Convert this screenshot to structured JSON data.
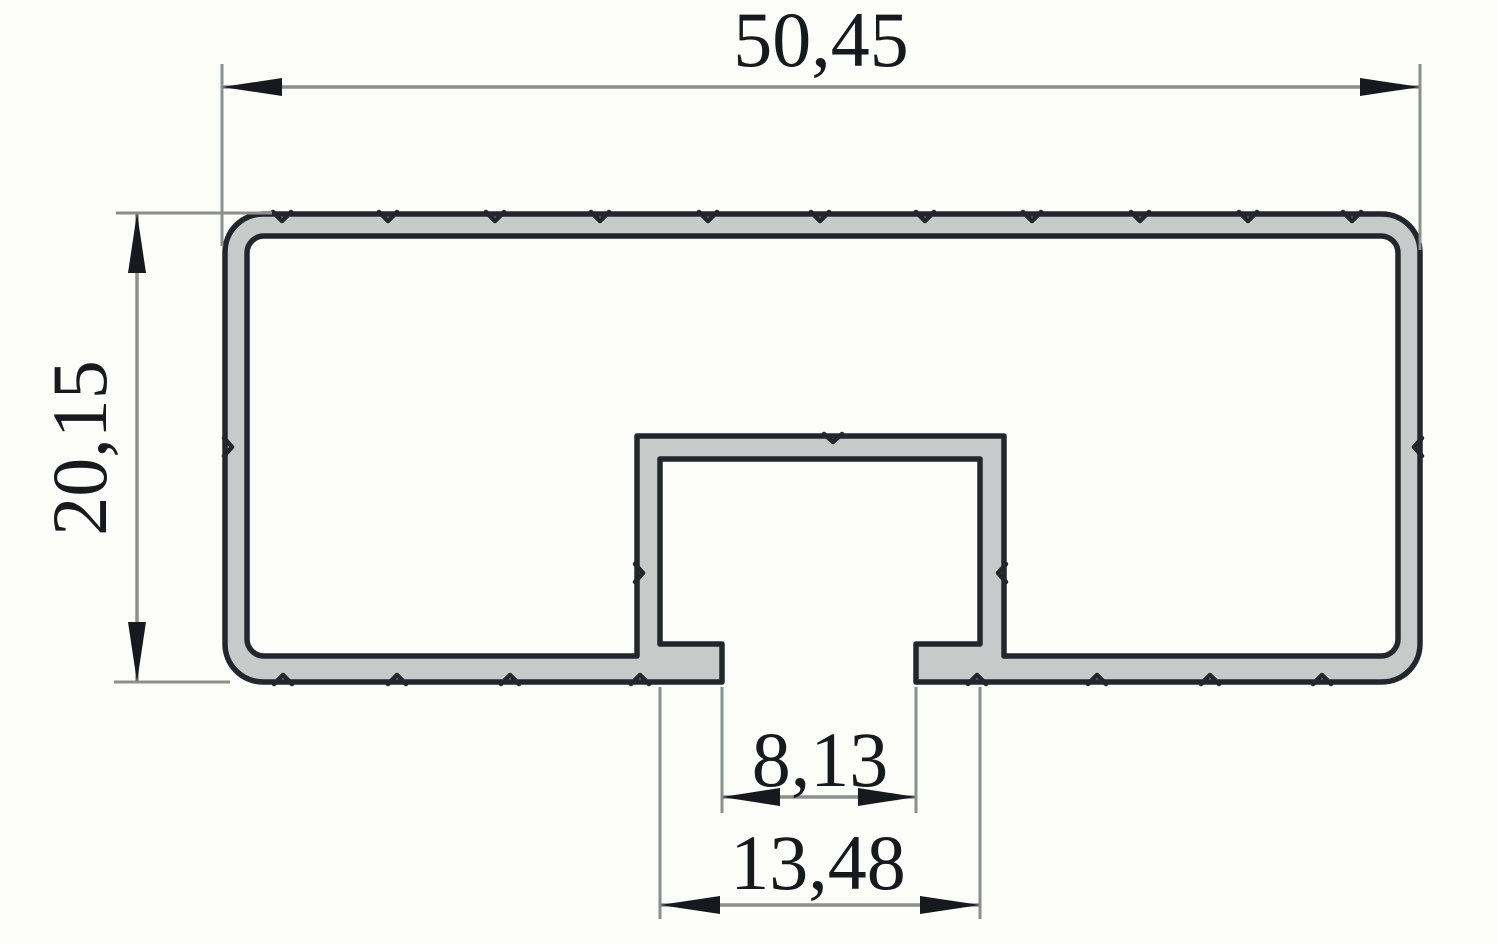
{
  "drawing": {
    "kind": "technical-cross-section",
    "subject": "rectangular-tube-profile-with-bottom-channel-slot",
    "colors": {
      "background": "#fcfcf9",
      "profile_fill": "#c6cac9",
      "outline": "#23262c",
      "dimension_line": "#8b8f8e",
      "text": "#16191e"
    },
    "dimensions": {
      "overall_width": "50,45",
      "overall_height": "20,15",
      "slot_opening": "8,13",
      "slot_inner_width": "13,48"
    }
  }
}
